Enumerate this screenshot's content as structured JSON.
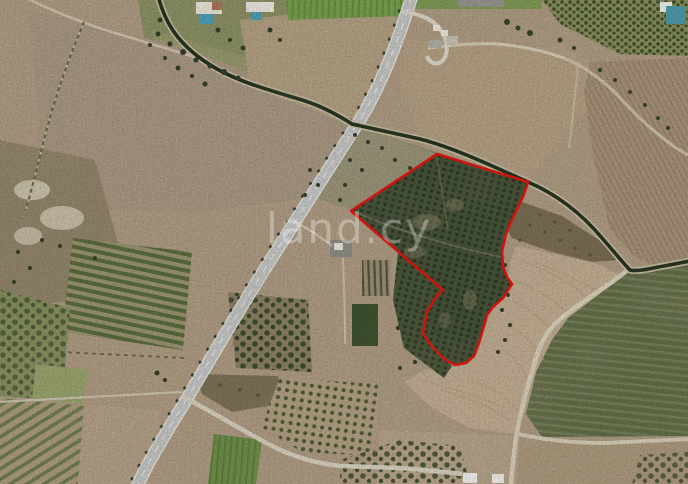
{
  "page": {
    "description": "Satellite aerial view of agricultural land with a plot for sale outlined in red",
    "watermark": "land.cy"
  },
  "parcel": {
    "outline_color": "#e3150d",
    "stroke_width": "2.6",
    "outline_points": "437,154 528,182 523,197 513,217 506,234 502,252 503,266 507,277 512,284 503,298 493,307 487,315 483,329 479,343 474,356 466,363 455,365 443,358 430,344 423,333 427,312 436,297 443,290 351,211"
  },
  "palette": {
    "terrain_tan": "#b09d84",
    "orchard_dark_green": "#46533a",
    "crop_bright_green": "#6f9149",
    "road_light_gray": "#c5c8c6",
    "tree_line_dark_green": "#26341f",
    "pool_blue": "#4aa0ba",
    "watermark_color": "rgba(255,255,255,0.32)"
  }
}
